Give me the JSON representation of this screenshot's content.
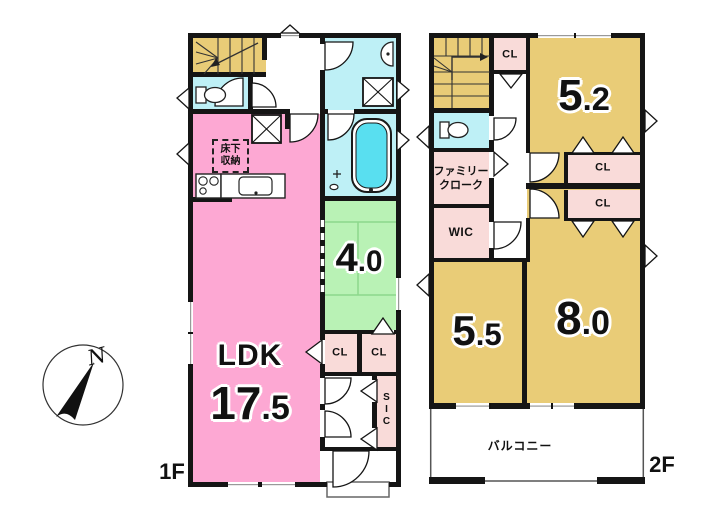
{
  "colors": {
    "wall": "#151515",
    "ldk_pink": "#fda8d3",
    "closet_pink": "#f9dbd9",
    "tatami_green": "#b9f2b5",
    "tatami_line": "#8cd88c",
    "wet_cyan": "#bef0f6",
    "tub_cyan": "#59dff0",
    "room_tan": "#e9cc77",
    "outline_gray": "#666666"
  },
  "floor1": {
    "label": "1F",
    "ldk_name": "LDK",
    "ldk_area_int": "17",
    "ldk_area_dec": ".5",
    "washitsu_area_int": "4",
    "washitsu_area_dec": ".0",
    "underfloor_line1": "床下",
    "underfloor_line2": "収納",
    "closet_left": "CL",
    "closet_right": "CL",
    "shoe_closet": "SIC"
  },
  "floor2": {
    "label": "2F",
    "room52_area_int": "5",
    "room52_area_dec": ".2",
    "room55_area_int": "5",
    "room55_area_dec": ".5",
    "room80_area_int": "8",
    "room80_area_dec": ".0",
    "closet_top": "CL",
    "closet_upper": "CL",
    "closet_lower": "CL",
    "wic": "WIC",
    "family_closet_line1": "ファミリー",
    "family_closet_line2": "クローク",
    "balcony": "バルコニー"
  },
  "compass": {
    "north": "N"
  }
}
